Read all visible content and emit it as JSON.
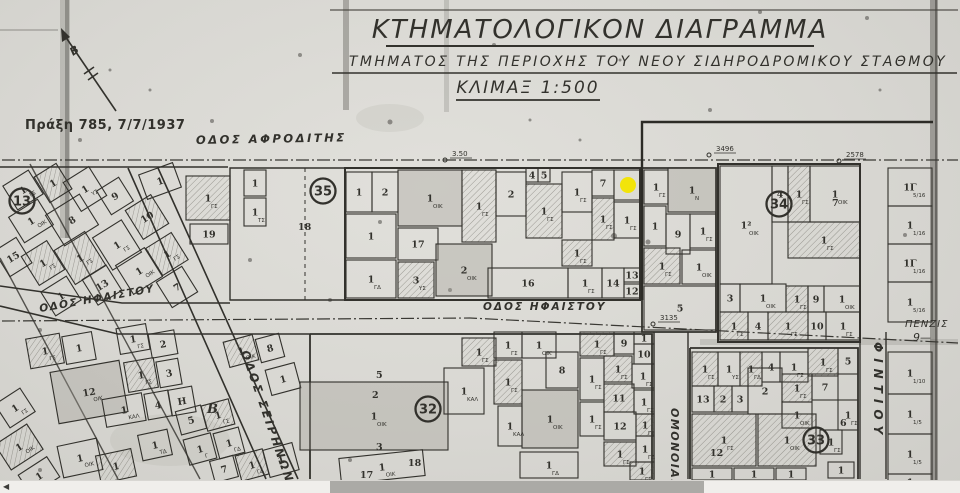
{
  "title": {
    "line1": "ΚΤΗΜΑΤΟΛΟΓΙΚΟΝ ΔΙΑΓΡΑΜΜΑ",
    "line2": "ΤΜΗΜΑΤΟΣ ΤΗΣ ΠΕΡΙΟΧΗΣ ΤΟΥ ΝΕΟΥ ΣΙΔΗΡΟΔΡΟΜΙΚΟΥ ΣΤΑΘΜΟΥ",
    "line3": "ΚΛΙΜΑΞ 1:500"
  },
  "annotation": {
    "text": "Πράξη 785, 7/7/1937",
    "color": "#bb3430"
  },
  "north_label": "Β",
  "side_note": {
    "line1": "ΠΕΝΖΙΣ",
    "line2": "9—"
  },
  "colors": {
    "paper": "#d8d7d2",
    "ink": "#32312c",
    "accent_red": "#bb3430",
    "marker_yellow": "#f2e40a",
    "scroll_thumb": "#abaaa6"
  },
  "marker": {
    "x": 628,
    "y": 185,
    "r": 8
  },
  "scrollbar": {
    "arrow_left": "◀",
    "thumb_x": 330,
    "thumb_w": 374
  },
  "streets": [
    {
      "name": "ΟΔΟΣ ΑΦΡΟΔΙΤΗΣ",
      "x": 196,
      "y": 144,
      "rot": -1,
      "fs": 11.5,
      "ls": 2.5
    },
    {
      "name": "ΟΔΟΣ ΗΦΑΙΣΤΟΥ",
      "x": 483,
      "y": 310,
      "rot": 0,
      "fs": 10.5,
      "ls": 2
    },
    {
      "name": "ΟΔΟΣ ΗΦΑΙΣΤΟΥ",
      "x": 40,
      "y": 312,
      "rot": -10,
      "fs": 10.5,
      "ls": 1.5
    },
    {
      "name": "ΟΔΟΣ ΣΕΙΡΗΝΩΝ",
      "x": 241,
      "y": 352,
      "rot": 71,
      "fs": 11.5,
      "ls": 2.5
    },
    {
      "name": "ΟΜΟΝΟΙΑΣ",
      "x": 671,
      "y": 408,
      "rot": 90,
      "fs": 11,
      "ls": 1.5
    },
    {
      "name": "ΦΙΝΤΙΟΥ",
      "x": 874,
      "y": 342,
      "rot": 90,
      "fs": 12,
      "ls": 6
    }
  ],
  "blocks": [
    {
      "num": "13",
      "x": 22,
      "y": 201
    },
    {
      "num": "35",
      "x": 323,
      "y": 191
    },
    {
      "num": "34",
      "x": 779,
      "y": 204
    },
    {
      "num": "32",
      "x": 428,
      "y": 409
    },
    {
      "num": "33",
      "x": 816,
      "y": 440
    }
  ],
  "measurements": [
    {
      "text": "3.50",
      "x": 452,
      "y": 156
    },
    {
      "text": "3496",
      "x": 716,
      "y": 151
    },
    {
      "text": "2578",
      "x": 846,
      "y": 157
    },
    {
      "text": "3135",
      "x": 660,
      "y": 320
    }
  ],
  "free_labels": [
    {
      "text": "18",
      "x": 298,
      "y": 230
    },
    {
      "text": "7",
      "x": 832,
      "y": 206
    },
    {
      "text": "12",
      "x": 710,
      "y": 456
    },
    {
      "text": "6",
      "x": 840,
      "y": 426
    },
    {
      "text": "2",
      "x": 372,
      "y": 398
    },
    {
      "text": "5",
      "x": 376,
      "y": 378
    },
    {
      "text": "3",
      "x": 376,
      "y": 450
    },
    {
      "text": "18",
      "x": 408,
      "y": 466
    },
    {
      "text": "17",
      "x": 360,
      "y": 478
    },
    {
      "text": "B",
      "x": 207,
      "y": 413
    }
  ],
  "parcels": [
    [
      8,
      176,
      30,
      28,
      "1",
      "ΓΣ",
      0,
      -32
    ],
    [
      40,
      168,
      26,
      30,
      "1",
      "",
      1,
      -32
    ],
    [
      70,
      172,
      30,
      34,
      "1",
      "ΥΣ",
      0,
      -32
    ],
    [
      102,
      182,
      26,
      28,
      "9",
      "",
      0,
      -32
    ],
    [
      52,
      202,
      40,
      36,
      "8",
      "",
      0,
      -32
    ],
    [
      14,
      206,
      34,
      30,
      "1",
      "ΟΙΚ",
      0,
      -32
    ],
    [
      0,
      242,
      26,
      30,
      "15",
      "",
      0,
      -32
    ],
    [
      28,
      246,
      30,
      34,
      "1",
      "ΓΣ",
      1,
      -32
    ],
    [
      62,
      238,
      36,
      40,
      "1",
      "ΓΣ",
      1,
      -32
    ],
    [
      100,
      226,
      34,
      38,
      "1",
      "ΓΣ",
      0,
      -32
    ],
    [
      132,
      200,
      30,
      34,
      "10",
      "",
      1,
      -32
    ],
    [
      122,
      254,
      34,
      34,
      "1",
      "ΟΙΚ",
      0,
      -32
    ],
    [
      88,
      270,
      28,
      30,
      "13",
      "",
      0,
      -32
    ],
    [
      46,
      282,
      30,
      28,
      "1",
      "",
      0,
      -32
    ],
    [
      152,
      238,
      30,
      32,
      "1",
      "ΓΣ",
      1,
      -32
    ],
    [
      162,
      272,
      30,
      30,
      "7",
      "",
      0,
      -32
    ],
    [
      186,
      176,
      44,
      44,
      "1",
      "ΓΣ",
      1,
      0
    ],
    [
      190,
      224,
      38,
      20,
      "19",
      "",
      0,
      0
    ],
    [
      142,
      168,
      36,
      26,
      "1",
      "",
      0,
      -20
    ],
    [
      244,
      170,
      22,
      26,
      "1",
      "",
      0,
      0
    ],
    [
      244,
      198,
      22,
      28,
      "1",
      "ΤΣ",
      0,
      0
    ],
    [
      346,
      172,
      26,
      40,
      "1",
      "",
      0,
      0
    ],
    [
      372,
      172,
      26,
      40,
      "2",
      "",
      0,
      0
    ],
    [
      398,
      170,
      64,
      56,
      "1",
      "ΟΙΚ",
      2,
      0
    ],
    [
      462,
      170,
      34,
      72,
      "1",
      "ΓΣ",
      1,
      0
    ],
    [
      496,
      172,
      30,
      44,
      "2",
      "",
      0,
      0
    ],
    [
      526,
      168,
      12,
      14,
      "4",
      "",
      0,
      0
    ],
    [
      538,
      168,
      12,
      14,
      "5",
      "",
      0,
      0
    ],
    [
      526,
      184,
      36,
      54,
      "1",
      "ΓΣ",
      1,
      0
    ],
    [
      562,
      172,
      30,
      40,
      "1",
      "ΓΣ",
      0,
      0
    ],
    [
      592,
      170,
      22,
      26,
      "7",
      "",
      0,
      0
    ],
    [
      614,
      170,
      26,
      30,
      "8",
      "",
      0,
      0
    ],
    [
      592,
      198,
      22,
      42,
      "1",
      "ΓΣ",
      1,
      0
    ],
    [
      614,
      202,
      26,
      36,
      "1",
      "ΓΣ",
      0,
      0
    ],
    [
      346,
      214,
      50,
      44,
      "1",
      "",
      0,
      0
    ],
    [
      398,
      228,
      40,
      32,
      "17",
      "",
      0,
      0
    ],
    [
      398,
      262,
      36,
      36,
      "3",
      "ΥΣ",
      1,
      0
    ],
    [
      436,
      244,
      56,
      52,
      "2",
      "ΟΙΚ",
      2,
      0
    ],
    [
      488,
      268,
      80,
      30,
      "16",
      "",
      0,
      0
    ],
    [
      568,
      268,
      34,
      30,
      "1",
      "ΓΣ",
      0,
      0
    ],
    [
      602,
      268,
      22,
      30,
      "14",
      "",
      0,
      0
    ],
    [
      624,
      268,
      16,
      14,
      "13",
      "",
      0,
      0
    ],
    [
      624,
      284,
      16,
      14,
      "12",
      "",
      0,
      0
    ],
    [
      562,
      240,
      30,
      26,
      "1",
      "ΓΣ",
      1,
      0
    ],
    [
      346,
      260,
      50,
      38,
      "1",
      "ΓΔ",
      0,
      0
    ],
    [
      644,
      170,
      24,
      34,
      "1",
      "ΓΣ",
      0,
      0
    ],
    [
      668,
      168,
      48,
      44,
      "1",
      "Ν",
      2,
      0
    ],
    [
      644,
      206,
      22,
      40,
      "1",
      "",
      0,
      0
    ],
    [
      666,
      214,
      24,
      40,
      "9",
      "",
      0,
      0
    ],
    [
      690,
      214,
      26,
      34,
      "1",
      "ΓΣ",
      0,
      0
    ],
    [
      644,
      248,
      36,
      36,
      "1",
      "ΓΣ",
      1,
      0
    ],
    [
      682,
      250,
      34,
      34,
      "1",
      "ΟΙΚ",
      0,
      0
    ],
    [
      644,
      286,
      72,
      44,
      "5",
      "",
      0,
      0
    ],
    [
      720,
      166,
      52,
      118,
      "1²",
      "ΟΙΚ",
      0,
      0
    ],
    [
      772,
      166,
      16,
      56,
      "4",
      "",
      0,
      0
    ],
    [
      788,
      166,
      22,
      56,
      "1",
      "ΓΣ",
      1,
      0
    ],
    [
      810,
      166,
      50,
      56,
      "1",
      "ΟΙΚ",
      0,
      0
    ],
    [
      788,
      222,
      72,
      36,
      "1",
      "ΓΣ",
      1,
      0
    ],
    [
      720,
      284,
      20,
      28,
      "3",
      "",
      0,
      0
    ],
    [
      740,
      284,
      46,
      28,
      "1",
      "ΟΙΚ",
      0,
      0
    ],
    [
      786,
      286,
      22,
      26,
      "1",
      "ΓΣ",
      1,
      0
    ],
    [
      808,
      286,
      16,
      26,
      "9",
      "",
      0,
      0
    ],
    [
      824,
      286,
      36,
      26,
      "1",
      "ΟΙΚ",
      0,
      0
    ],
    [
      720,
      312,
      28,
      28,
      "1",
      "ΓΣ",
      1,
      0
    ],
    [
      748,
      312,
      20,
      28,
      "4",
      "",
      0,
      0
    ],
    [
      768,
      312,
      40,
      28,
      "1",
      "ΓΣ",
      1,
      0
    ],
    [
      808,
      312,
      18,
      28,
      "10",
      "",
      0,
      0
    ],
    [
      826,
      312,
      34,
      28,
      "1",
      "ΓΣ",
      0,
      0
    ],
    [
      888,
      168,
      44,
      38,
      "1Γ",
      "5/16",
      0,
      0
    ],
    [
      888,
      206,
      44,
      38,
      "1",
      "1/16",
      0,
      0
    ],
    [
      888,
      244,
      44,
      38,
      "1Γ",
      "1/16",
      0,
      0
    ],
    [
      888,
      282,
      44,
      40,
      "1",
      "5/16",
      0,
      0
    ],
    [
      888,
      352,
      44,
      42,
      "1",
      "1/10",
      0,
      0
    ],
    [
      888,
      394,
      44,
      40,
      "1",
      "1/5",
      0,
      0
    ],
    [
      888,
      434,
      44,
      40,
      "1",
      "1/5",
      0,
      0
    ],
    [
      888,
      474,
      44,
      16,
      "1",
      "",
      0,
      0
    ],
    [
      28,
      336,
      34,
      30,
      "1",
      "ΓΣ",
      1,
      -10
    ],
    [
      64,
      334,
      30,
      28,
      "1",
      "",
      0,
      -10
    ],
    [
      118,
      326,
      30,
      26,
      "1",
      "ΓΣ",
      0,
      -10
    ],
    [
      150,
      332,
      26,
      24,
      "2",
      "",
      0,
      -10
    ],
    [
      54,
      366,
      70,
      52,
      "12",
      "ΟΙΚ",
      2,
      -10
    ],
    [
      126,
      360,
      30,
      30,
      "1",
      "ΓΣ",
      1,
      -10
    ],
    [
      158,
      360,
      22,
      26,
      "3",
      "",
      0,
      -10
    ],
    [
      104,
      396,
      40,
      28,
      "1",
      "ΚΑΛ",
      0,
      -10
    ],
    [
      146,
      392,
      24,
      26,
      "4",
      "",
      0,
      -10
    ],
    [
      170,
      388,
      24,
      26,
      "Η",
      "",
      0,
      -10
    ],
    [
      178,
      408,
      26,
      24,
      "5",
      "",
      0,
      -15
    ],
    [
      204,
      402,
      28,
      26,
      "1",
      "ΓΣ",
      1,
      -15
    ],
    [
      186,
      436,
      28,
      26,
      "1",
      "Γ",
      0,
      -15
    ],
    [
      216,
      430,
      26,
      26,
      "1",
      "ΓΔ",
      0,
      -15
    ],
    [
      212,
      458,
      24,
      22,
      "7",
      "",
      0,
      -15
    ],
    [
      238,
      452,
      28,
      26,
      "1",
      "ΓΔ",
      1,
      -15
    ],
    [
      266,
      446,
      30,
      28,
      "1",
      "",
      0,
      -15
    ],
    [
      226,
      338,
      30,
      26,
      "1",
      "ΟΙΚ",
      1,
      -15
    ],
    [
      258,
      336,
      24,
      24,
      "8",
      "",
      0,
      -15
    ],
    [
      268,
      366,
      30,
      26,
      "1",
      "",
      0,
      -15
    ],
    [
      0,
      394,
      30,
      28,
      "1",
      "ΓΣ",
      0,
      -33
    ],
    [
      0,
      432,
      38,
      30,
      "1",
      "ΟΙΚ",
      1,
      -33
    ],
    [
      22,
      464,
      34,
      24,
      "1",
      "",
      0,
      -33
    ],
    [
      60,
      442,
      40,
      32,
      "1",
      "ΟΙΚ",
      0,
      -12
    ],
    [
      98,
      452,
      36,
      28,
      "1",
      "",
      1,
      -12
    ],
    [
      140,
      432,
      30,
      26,
      "1",
      "ΤΔ",
      0,
      -12
    ],
    [
      300,
      382,
      148,
      68,
      "1",
      "ΟΙΚ",
      2,
      0
    ],
    [
      444,
      368,
      40,
      46,
      "1",
      "ΚΑΛ",
      0,
      0
    ],
    [
      462,
      338,
      34,
      28,
      "1",
      "ΓΣ",
      1,
      0
    ],
    [
      340,
      454,
      84,
      26,
      "1",
      "ΟΙΚ",
      0,
      -6
    ],
    [
      494,
      332,
      28,
      26,
      "1",
      "ΓΣ",
      0,
      0
    ],
    [
      522,
      332,
      34,
      26,
      "1",
      "ΟΙΚ",
      0,
      0
    ],
    [
      494,
      360,
      28,
      44,
      "1",
      "ΓΣ",
      1,
      0
    ],
    [
      546,
      352,
      32,
      36,
      "8",
      "",
      0,
      0
    ],
    [
      580,
      332,
      34,
      24,
      "1",
      "ΓΣ",
      1,
      0
    ],
    [
      614,
      332,
      20,
      22,
      "9",
      "",
      0,
      0
    ],
    [
      634,
      332,
      20,
      12,
      "1",
      "",
      0,
      0
    ],
    [
      634,
      344,
      20,
      20,
      "10",
      "",
      0,
      0
    ],
    [
      604,
      356,
      28,
      26,
      "1",
      "ΓΣ",
      1,
      0
    ],
    [
      632,
      364,
      22,
      24,
      "1",
      "ΓΣ",
      0,
      0
    ],
    [
      580,
      358,
      24,
      42,
      "1",
      "ΓΣ",
      0,
      0
    ],
    [
      604,
      384,
      30,
      28,
      "11",
      "",
      1,
      0
    ],
    [
      634,
      390,
      20,
      24,
      "1",
      "ΓΣ",
      0,
      0
    ],
    [
      580,
      402,
      24,
      34,
      "1",
      "ΓΣ",
      0,
      0
    ],
    [
      604,
      412,
      32,
      28,
      "12",
      "",
      0,
      0
    ],
    [
      636,
      414,
      18,
      22,
      "1",
      "ΓΣ",
      1,
      0
    ],
    [
      604,
      442,
      32,
      24,
      "1",
      "ΓΣ",
      1,
      0
    ],
    [
      636,
      436,
      18,
      26,
      "1",
      "ΓΔ",
      0,
      0
    ],
    [
      522,
      390,
      56,
      58,
      "1",
      "ΟΙΚ",
      2,
      0
    ],
    [
      498,
      406,
      24,
      40,
      "1",
      "ΚΑΛ",
      0,
      0
    ],
    [
      520,
      452,
      58,
      26,
      "1",
      "ΓΔ",
      0,
      0
    ],
    [
      630,
      462,
      24,
      18,
      "1",
      "ΓΣ",
      1,
      0
    ],
    [
      692,
      352,
      26,
      34,
      "1",
      "ΓΣ",
      1,
      0
    ],
    [
      718,
      352,
      22,
      34,
      "1",
      "ΥΣ",
      0,
      0
    ],
    [
      740,
      352,
      22,
      34,
      "1",
      "ΓΔ",
      1,
      0
    ],
    [
      762,
      352,
      18,
      30,
      "4",
      "",
      0,
      0
    ],
    [
      780,
      352,
      28,
      30,
      "1",
      "ΓΣ",
      0,
      0
    ],
    [
      808,
      348,
      30,
      28,
      "1",
      "ΓΣ",
      1,
      0
    ],
    [
      838,
      348,
      20,
      26,
      "5",
      "",
      0,
      0
    ],
    [
      692,
      386,
      22,
      26,
      "13",
      "",
      0,
      0
    ],
    [
      714,
      386,
      18,
      26,
      "2",
      "",
      1,
      0
    ],
    [
      732,
      386,
      16,
      26,
      "3",
      "",
      0,
      0
    ],
    [
      748,
      368,
      34,
      46,
      "2",
      "",
      0,
      0
    ],
    [
      782,
      374,
      30,
      28,
      "1",
      "ΓΣ",
      1,
      0
    ],
    [
      812,
      374,
      26,
      26,
      "7",
      "",
      0,
      0
    ],
    [
      782,
      402,
      30,
      26,
      "1",
      "ΟΙΚ",
      0,
      0
    ],
    [
      692,
      414,
      64,
      52,
      "1",
      "ΓΣ",
      1,
      0
    ],
    [
      758,
      414,
      58,
      52,
      "1",
      "ΟΙΚ",
      1,
      0
    ],
    [
      838,
      400,
      20,
      30,
      "1",
      "ΓΣ",
      0,
      0
    ],
    [
      820,
      430,
      22,
      24,
      "1",
      "ΓΣ",
      0,
      0
    ],
    [
      692,
      468,
      40,
      12,
      "1",
      "",
      0,
      0
    ],
    [
      734,
      468,
      40,
      12,
      "1",
      "ΓΣ",
      0,
      0
    ],
    [
      776,
      468,
      30,
      12,
      "1",
      "ΙΔ",
      0,
      0
    ],
    [
      828,
      462,
      26,
      16,
      "1",
      "",
      0,
      0
    ]
  ]
}
